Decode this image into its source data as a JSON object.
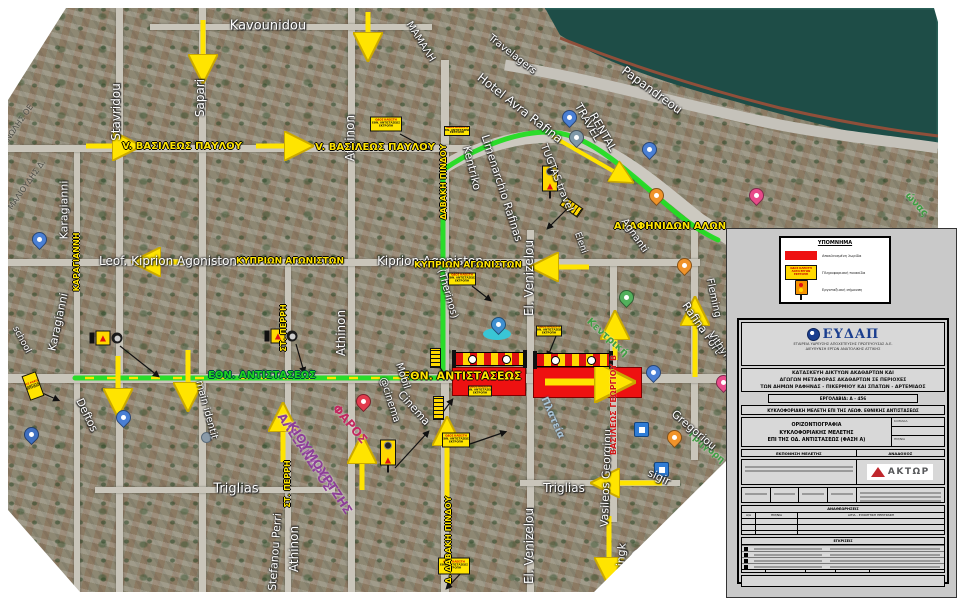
{
  "legend": {
    "title": "ΥΠΟΜΝΗΜΑ",
    "items": [
      {
        "label": "Αποκλεισμένη λωρίδα"
      },
      {
        "label": "Πληροφοριακή πινακίδα"
      },
      {
        "label": "Εργοταξιακή σήμανση"
      }
    ],
    "sign_lines": [
      "ΟΔΟΣ ΚΛΕΙΣΤΗ",
      "ΛΟΓΩ ΕΡΓΩΝ",
      "ΕΚΤΡΟΠΗ"
    ]
  },
  "title_block": {
    "company_logo": "ΕΥΔΑΠ",
    "company_line1": "ΕΤΑΙΡΕΙΑ ΥΔΡΕΥΣΗΣ ΑΠΟΧΕΤΕΥΣΗΣ ΠΡΩΤΕΥΟΥΣΑΣ Α.Ε.",
    "company_line2": "ΔΙΕΥΘΥΝΣΗ ΕΡΓΩΝ ΑΝΑΤΟΛΙΚΗΣ ΑΤΤΙΚΗΣ",
    "project_line1": "ΚΑΤΑΣΚΕΥΗ ΔΙΚΤΥΩΝ ΑΚΑΘΑΡΤΩΝ ΚΑΙ",
    "project_line2": "ΑΓΩΓΩΝ ΜΕΤΑΦΟΡΑΣ ΑΚΑΘΑΡΤΩΝ ΣΕ ΠΕΡΙΟΧΕΣ",
    "project_line3": "ΤΩΝ ΔΗΜΩΝ ΡΑΦΗΝΑΣ - ΠΙΚΕΡΜΙΟΥ ΚΑΙ ΣΠΑΤΩΝ - ΑΡΤΕΜΙΔΟΣ",
    "contract": "ΕΡΓΟΛΑΒΙΑ: Α - 456",
    "study": "ΚΥΚΛΟΦΟΡΙΑΚΗ ΜΕΛΕΤΗ ΕΠΙ ΤΗΣ ΛΕΩΦ. ΕΘΝΙΚΗΣ ΑΝΤΙΣΤΑΣΕΩΣ",
    "drawing_line1": "ΟΡΙΖΟΝΤΙΟΓΡΑΦΙΑ",
    "drawing_line2": "ΚΥΚΛΟΦΟΡΙΑΚΗΣ ΜΕΛΕΤΗΣ",
    "drawing_line3": "ΕΠΙ ΤΗΣ ΟΔ. ΑΝΤΙΣΤΑΣΕΩΣ (ΦΑΣΗ Α)",
    "scale_label": "ΚΛΙΜΑΚΑ",
    "date_label": "ΗΜ/ΝΙΑ",
    "col_left_header": "ΕΚΠΟΝΗΣΗ ΜΕΛΕΤΗΣ",
    "col_right_header": "ΑΝΑΔΟΧΟΣ",
    "contractor": "ΑΚΤΩΡ",
    "revisions_title": "ΑΝΑΘΕΩΡΗΣΕΙΣ",
    "rev_col1": "Α/Α",
    "rev_col2": "ΗΜ/ΝΙΑ",
    "rev_col3": "ΑΙΤΙΑ - ΣΥΝΟΠΤΙΚΗ ΠΕΡΙΓΡΑΦΗ",
    "approvals_title": "ΕΓΚΡΙΣΕΙΣ"
  },
  "map": {
    "watermark": "Google",
    "sign_lines": [
      "ΟΔΟΣ ΚΛΕΙΣΤΗ",
      "ΕΘΝ. ΑΝΤΙΣΤΑΣΕΩΣ",
      "ΕΚΤΡΟΠΗ"
    ],
    "detour_route": "M75,378 L443,378 L443,170 C460,158 505,132 548,132 C585,133 615,160 668,206 C690,225 705,234 718,240",
    "detour_dashes": "M85,378 L437,378",
    "street_labels": [
      {
        "t": "Kavounidou",
        "x": 268,
        "y": 26,
        "r": 0,
        "c": "lw",
        "s": 13
      },
      {
        "t": "Stavridou",
        "x": 116,
        "y": 112,
        "r": -90,
        "c": "lw",
        "s": 12
      },
      {
        "t": "Sapari",
        "x": 200,
        "y": 98,
        "r": -90,
        "c": "lw",
        "s": 12
      },
      {
        "t": "Athinon",
        "x": 350,
        "y": 138,
        "r": -90,
        "c": "lw",
        "s": 12
      },
      {
        "t": "Athinon",
        "x": 341,
        "y": 333,
        "r": -90,
        "c": "lw",
        "s": 12
      },
      {
        "t": "Athinon",
        "x": 294,
        "y": 549,
        "r": -90,
        "c": "lw",
        "s": 12
      },
      {
        "t": "V. ΒΑΣΙΛΕΩΣ ΠΑΥΛΟΥ",
        "x": 182,
        "y": 147,
        "r": 0,
        "c": "ly",
        "s": 10
      },
      {
        "t": "V. ΒΑΣΙΛΕΩΣ ΠΑΥΛΟΥ",
        "x": 375,
        "y": 148,
        "r": 0,
        "c": "ly",
        "s": 10
      },
      {
        "t": "Leof. Kiprion Agoniston",
        "x": 168,
        "y": 261,
        "r": 0,
        "c": "lw",
        "s": 12
      },
      {
        "t": "ΚΥΠΡΙΩΝ ΑΓΩΝΙΣΤΩΝ",
        "x": 290,
        "y": 262,
        "r": 0,
        "c": "ly",
        "s": 9
      },
      {
        "t": "Kiprion Agoniston",
        "x": 430,
        "y": 261,
        "r": 0,
        "c": "lw",
        "s": 12
      },
      {
        "t": "ΚΥΠΡΙΩΝ ΑΓΩΝΙΣΤΩΝ",
        "x": 468,
        "y": 266,
        "r": 0,
        "c": "ly",
        "s": 9
      },
      {
        "t": "ΚΑΡΑΓΙΑΝΝΗ",
        "x": 77,
        "y": 262,
        "r": -90,
        "c": "ly",
        "s": 8
      },
      {
        "t": "Karagianni",
        "x": 64,
        "y": 210,
        "r": -90,
        "c": "lw",
        "s": 11
      },
      {
        "t": "Karagianni",
        "x": 58,
        "y": 322,
        "r": -78,
        "c": "lw",
        "s": 11
      },
      {
        "t": "ΣΤ. ΠΕΡΡΗ",
        "x": 284,
        "y": 328,
        "r": -90,
        "c": "ly",
        "s": 8
      },
      {
        "t": "ΣΤ. ΠΕΡΡΗ",
        "x": 288,
        "y": 484,
        "r": -90,
        "c": "ly",
        "s": 8
      },
      {
        "t": "Stefanou Perri",
        "x": 275,
        "y": 552,
        "r": -86,
        "c": "lw",
        "s": 11
      },
      {
        "t": "ΔΑΒΑΚΗ ΠΙΝΔΟΥ",
        "x": 444,
        "y": 182,
        "r": -90,
        "c": "ly",
        "s": 8
      },
      {
        "t": "Δ. ΔΑΒΑΚΗ ΠΙΝΔΟΥ",
        "x": 449,
        "y": 540,
        "r": -90,
        "c": "ly",
        "s": 8
      },
      {
        "t": "El. Venizelou",
        "x": 529,
        "y": 278,
        "r": -90,
        "c": "lw",
        "s": 12
      },
      {
        "t": "El. Venizelou",
        "x": 529,
        "y": 546,
        "r": -90,
        "c": "lw",
        "s": 12
      },
      {
        "t": "Triglias",
        "x": 236,
        "y": 489,
        "r": 0,
        "c": "lw",
        "s": 13
      },
      {
        "t": "Triglias",
        "x": 564,
        "y": 488,
        "r": 0,
        "c": "lw",
        "s": 12
      },
      {
        "t": "Vasileos Georgiou",
        "x": 606,
        "y": 478,
        "r": -88,
        "c": "lw",
        "s": 11
      },
      {
        "t": "ΒΑΣΙΛΕΩΣ ΓΕΩΡΓΙΟΥ Β",
        "x": 614,
        "y": 405,
        "r": -90,
        "c": "lr",
        "s": 8
      },
      {
        "t": "ΕΘΝ. ΑΝΤΙΣΤΑΣΕΩΣ",
        "x": 262,
        "y": 376,
        "r": 0,
        "c": "lg",
        "s": 10
      },
      {
        "t": "ΕΘΝ. ΑΝΤΙΣΤΑΣΕΩΣ",
        "x": 462,
        "y": 376,
        "r": 0,
        "c": "ly",
        "s": 11
      },
      {
        "t": "ΑΡΑΦΗΝΙΔΩΝ ΑΛΩΝ",
        "x": 670,
        "y": 227,
        "r": 0,
        "c": "ly",
        "s": 10
      },
      {
        "t": "Hotel Avra Rafina",
        "x": 520,
        "y": 108,
        "r": 38,
        "c": "lw",
        "s": 12
      },
      {
        "t": "Travelagers",
        "x": 512,
        "y": 55,
        "r": 38,
        "c": "lw",
        "s": 10
      },
      {
        "t": "ΜΑΜΑΛΗ",
        "x": 420,
        "y": 42,
        "r": 58,
        "c": "lw",
        "s": 10
      },
      {
        "t": "Papandreou",
        "x": 652,
        "y": 90,
        "r": 36,
        "c": "lw",
        "s": 12
      },
      {
        "t": "TRAVEL",
        "x": 588,
        "y": 122,
        "r": 60,
        "c": "lw",
        "s": 11
      },
      {
        "t": "RENTAL",
        "x": 603,
        "y": 132,
        "r": 60,
        "c": "lw",
        "s": 11
      },
      {
        "t": "TUGTAS travel",
        "x": 556,
        "y": 178,
        "r": 68,
        "c": "lw",
        "s": 10
      },
      {
        "t": "Kentriko",
        "x": 472,
        "y": 168,
        "r": 76,
        "c": "lw",
        "s": 11
      },
      {
        "t": "Limenarchio Rafinas",
        "x": 502,
        "y": 188,
        "r": 72,
        "c": "lw",
        "s": 11
      },
      {
        "t": "(Therinos)",
        "x": 447,
        "y": 294,
        "r": 74,
        "c": "lw",
        "s": 10
      },
      {
        "t": "@cinema",
        "x": 389,
        "y": 400,
        "r": 72,
        "c": "lw",
        "s": 10
      },
      {
        "t": "Mobil",
        "x": 402,
        "y": 376,
        "r": 72,
        "c": "lw",
        "s": 10
      },
      {
        "t": "Cinema",
        "x": 414,
        "y": 408,
        "r": 48,
        "c": "lw",
        "s": 11
      },
      {
        "t": "ΑΛΕΞΑΝΔΡΟΣ",
        "x": 305,
        "y": 452,
        "r": 57,
        "c": "lp",
        "s": 12
      },
      {
        "t": "ΚΙΟΥΜΟΥΡΤΖΗΣ",
        "x": 320,
        "y": 468,
        "r": 57,
        "c": "lp",
        "s": 12
      },
      {
        "t": "ΦΑΡΟΣ",
        "x": 350,
        "y": 424,
        "r": 50,
        "c": "lm",
        "s": 12
      },
      {
        "t": "Πλατεία",
        "x": 552,
        "y": 418,
        "r": 66,
        "c": "lb",
        "s": 10
      },
      {
        "t": "Κεντρική",
        "x": 607,
        "y": 338,
        "r": 42,
        "c": "ld",
        "s": 10
      },
      {
        "t": "Γρηγόρη",
        "x": 706,
        "y": 448,
        "r": 40,
        "c": "ld",
        "s": 9
      },
      {
        "t": "Gregoriou",
        "x": 694,
        "y": 430,
        "r": 40,
        "c": "lw",
        "s": 11
      },
      {
        "t": "Rafina Port",
        "x": 702,
        "y": 328,
        "r": 55,
        "c": "lw",
        "s": 11
      },
      {
        "t": "Vithynias",
        "x": 723,
        "y": 352,
        "r": 55,
        "c": "lw",
        "s": 10
      },
      {
        "t": "Fleming",
        "x": 713,
        "y": 298,
        "r": 78,
        "c": "lw",
        "s": 10
      },
      {
        "t": "Agnanti",
        "x": 634,
        "y": 236,
        "r": 55,
        "c": "lw",
        "s": 10
      },
      {
        "t": "Eleni",
        "x": 580,
        "y": 243,
        "r": 70,
        "c": "lw",
        "s": 9
      },
      {
        "t": "sigir",
        "x": 659,
        "y": 477,
        "r": 25,
        "c": "lw",
        "s": 11
      },
      {
        "t": "mingk",
        "x": 621,
        "y": 560,
        "r": -86,
        "c": "lw",
        "s": 11
      },
      {
        "t": "school",
        "x": 21,
        "y": 340,
        "r": 62,
        "c": "lw",
        "s": 9
      },
      {
        "t": "Deftos",
        "x": 87,
        "y": 415,
        "r": 64,
        "c": "lw",
        "s": 11
      },
      {
        "t": "main identit",
        "x": 206,
        "y": 410,
        "r": 75,
        "c": "lw",
        "s": 10
      },
      {
        "t": "ΜΑΛΙΟΥΔΗΣ Δ.",
        "x": 27,
        "y": 185,
        "r": -55,
        "c": "lgr",
        "s": 8
      },
      {
        "t": "ΜΑΝΩΛΗΣ ΟΕ",
        "x": 16,
        "y": 128,
        "r": -55,
        "c": "lgr",
        "s": 8
      },
      {
        "t": "ώνας",
        "x": 916,
        "y": 205,
        "r": 48,
        "c": "ld",
        "s": 10
      },
      {
        "t": "Google",
        "x": 684,
        "y": 547,
        "r": -17,
        "c": "lwm",
        "s": 27
      }
    ],
    "arrows": [
      {
        "x1": 203,
        "y1": 20,
        "x2": 203,
        "y2": 74,
        "w": 5
      },
      {
        "x1": 86,
        "y1": 146,
        "x2": 132,
        "y2": 146,
        "w": 5
      },
      {
        "x1": 256,
        "y1": 146,
        "x2": 304,
        "y2": 146,
        "w": 5
      },
      {
        "x1": 368,
        "y1": 12,
        "x2": 368,
        "y2": 52,
        "w": 5
      },
      {
        "x1": 188,
        "y1": 350,
        "x2": 188,
        "y2": 402,
        "w": 5
      },
      {
        "x1": 118,
        "y1": 356,
        "x2": 118,
        "y2": 408,
        "w": 5
      },
      {
        "x1": 283,
        "y1": 462,
        "x2": 283,
        "y2": 412,
        "w": 5
      },
      {
        "x1": 362,
        "y1": 490,
        "x2": 362,
        "y2": 444,
        "w": 5
      },
      {
        "x1": 447,
        "y1": 497,
        "x2": 447,
        "y2": 426,
        "w": 5
      },
      {
        "x1": 615,
        "y1": 360,
        "x2": 615,
        "y2": 320,
        "w": 5
      },
      {
        "x1": 695,
        "y1": 377,
        "x2": 695,
        "y2": 306,
        "w": 5
      },
      {
        "x1": 183,
        "y1": 262,
        "x2": 141,
        "y2": 262,
        "w": 5
      },
      {
        "x1": 589,
        "y1": 267,
        "x2": 539,
        "y2": 267,
        "w": 5
      },
      {
        "x1": 662,
        "y1": 483,
        "x2": 600,
        "y2": 483,
        "w": 5
      },
      {
        "x1": 609,
        "y1": 516,
        "x2": 609,
        "y2": 577,
        "w": 5
      },
      {
        "x1": 545,
        "y1": 382,
        "x2": 622,
        "y2": 382,
        "w": 7
      },
      {
        "x1": 552,
        "y1": 136,
        "x2": 627,
        "y2": 179,
        "w": 4
      }
    ],
    "leaders": [
      [
        400,
        134,
        428,
        149
      ],
      [
        472,
        286,
        490,
        300
      ],
      [
        556,
        336,
        548,
        356
      ],
      [
        470,
        444,
        505,
        432
      ],
      [
        462,
        572,
        447,
        588
      ],
      [
        40,
        392,
        58,
        400
      ],
      [
        120,
        346,
        158,
        376
      ],
      [
        296,
        344,
        304,
        372
      ],
      [
        566,
        210,
        548,
        228
      ],
      [
        395,
        468,
        428,
        432
      ],
      [
        436,
        362,
        446,
        376
      ],
      [
        440,
        416,
        452,
        400
      ]
    ],
    "zones": [
      {
        "x": 452,
        "y": 367,
        "w": 72,
        "h": 27
      },
      {
        "x": 533,
        "y": 367,
        "w": 107,
        "h": 29
      }
    ],
    "barriers": [
      {
        "x": 455,
        "y": 352,
        "w": 67
      },
      {
        "x": 536,
        "y": 353,
        "w": 72
      }
    ],
    "assemblies_h": [
      [
        106,
        338
      ],
      [
        281,
        336
      ]
    ],
    "assemblies_v": [
      [
        388,
        456
      ],
      [
        550,
        182
      ]
    ],
    "strips": [
      {
        "x": 430,
        "y": 348,
        "w": 9,
        "h": 18,
        "r": 0
      },
      {
        "x": 433,
        "y": 396,
        "w": 9,
        "h": 22,
        "r": 0
      },
      {
        "x": 566,
        "y": 196,
        "w": 9,
        "h": 20,
        "r": -55
      }
    ],
    "info_signs": [
      {
        "x": 386,
        "y": 124,
        "w": 30,
        "h": 13,
        "r": 0
      },
      {
        "x": 462,
        "y": 279,
        "w": 26,
        "h": 11,
        "r": 0
      },
      {
        "x": 480,
        "y": 391,
        "w": 22,
        "h": 9,
        "r": 0
      },
      {
        "x": 549,
        "y": 331,
        "w": 24,
        "h": 9,
        "r": 0
      },
      {
        "x": 456,
        "y": 440,
        "w": 26,
        "h": 13,
        "r": 0
      },
      {
        "x": 454,
        "y": 566,
        "w": 30,
        "h": 15,
        "r": 0
      },
      {
        "x": 33,
        "y": 386,
        "w": 13,
        "h": 24,
        "r": -20
      },
      {
        "x": 457,
        "y": 131,
        "w": 24,
        "h": 8,
        "r": 0
      }
    ],
    "pins": [
      {
        "x": 38,
        "y": 242,
        "c": "#4a7fd4",
        "k": "pin"
      },
      {
        "x": 30,
        "y": 437,
        "c": "#3f6fc0",
        "k": "pin"
      },
      {
        "x": 122,
        "y": 420,
        "c": "#4a7fd4",
        "k": "pin"
      },
      {
        "x": 205,
        "y": 436,
        "c": "",
        "k": "dot"
      },
      {
        "x": 362,
        "y": 404,
        "c": "#e23b4e",
        "k": "pin"
      },
      {
        "x": 497,
        "y": 327,
        "c": "#3f8fd0",
        "k": "pin"
      },
      {
        "x": 575,
        "y": 140,
        "c": "#7f98a8",
        "k": "pin"
      },
      {
        "x": 568,
        "y": 120,
        "c": "#4a7fd4",
        "k": "pin"
      },
      {
        "x": 648,
        "y": 152,
        "c": "#4a7fd4",
        "k": "pin"
      },
      {
        "x": 655,
        "y": 198,
        "c": "#f0932a",
        "k": "pin"
      },
      {
        "x": 683,
        "y": 268,
        "c": "#f0932a",
        "k": "pin"
      },
      {
        "x": 755,
        "y": 198,
        "c": "#e84b8a",
        "k": "pin"
      },
      {
        "x": 625,
        "y": 300,
        "c": "#52b05c",
        "k": "pin"
      },
      {
        "x": 652,
        "y": 375,
        "c": "#4a7fd4",
        "k": "pin"
      },
      {
        "x": 673,
        "y": 440,
        "c": "#f0932a",
        "k": "pin"
      },
      {
        "x": 640,
        "y": 428,
        "c": "",
        "k": "sq"
      },
      {
        "x": 660,
        "y": 468,
        "c": "",
        "k": "sq"
      },
      {
        "x": 722,
        "y": 385,
        "c": "#e84b8a",
        "k": "pin"
      }
    ]
  }
}
